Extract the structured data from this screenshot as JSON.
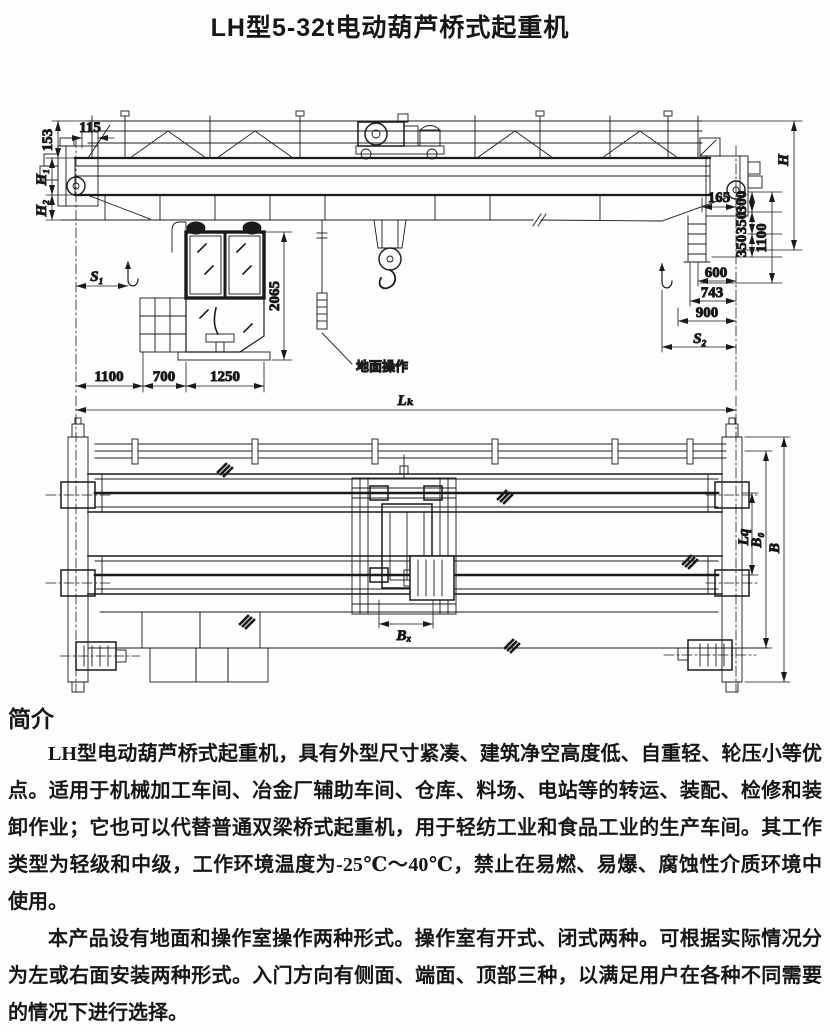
{
  "page": {
    "title": "LH型5-32t电动葫芦桥式起重机",
    "line_color": "#1a1a1a",
    "background_color": "#fdfdfc"
  },
  "front_view": {
    "dims": {
      "d115": "115",
      "d153": "153",
      "h1": "H₁",
      "h2": "H₂",
      "s1": "S₁",
      "d2065": "2065",
      "d1100_left": "1100",
      "d700": "700",
      "d1250": "1250",
      "h": "H",
      "d165": "165",
      "d300": "300",
      "d350a": "350",
      "d350b": "350",
      "d1100_right": "1100",
      "d600": "600",
      "d743": "743",
      "d900": "900",
      "s2": "S₂",
      "ground_note": "地面操作"
    }
  },
  "plan_view": {
    "dims": {
      "lk": "Lₖ",
      "bx": "Bₓ",
      "lq": "Lq",
      "b0": "B₀",
      "b": "B"
    }
  },
  "intro": {
    "heading": "简介",
    "paragraphs": [
      "LH型电动葫芦桥式起重机，具有外型尺寸紧凑、建筑净空高度低、自重轻、轮压小等优点。适用于机械加工车间、冶金厂辅助车间、仓库、料场、电站等的转运、装配、检修和装卸作业；它也可以代替普通双梁桥式起重机，用于轻纺工业和食品工业的生产车间。其工作类型为轻级和中级，工作环境温度为-25℃～40℃，禁止在易燃、易爆、腐蚀性介质环境中使用。",
      "本产品设有地面和操作室操作两种形式。操作室有开式、闭式两种。可根据实际情况分为左或右面安装两种形式。入门方向有侧面、端面、顶部三种，以满足用户在各种不同需要的情况下进行选择。"
    ]
  }
}
